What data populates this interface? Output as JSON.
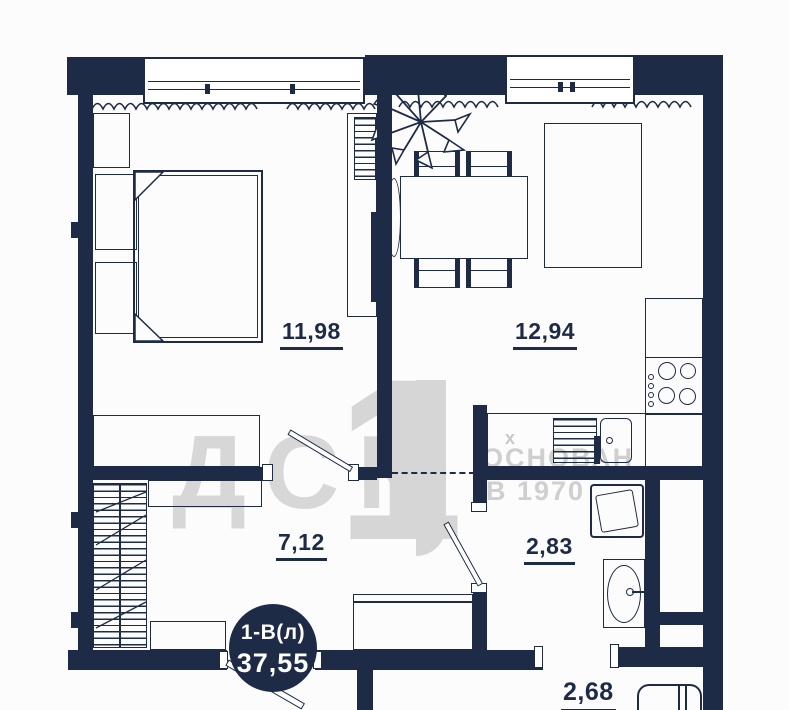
{
  "floor_plan": {
    "unit_badge": {
      "unit_type": "1-В(л)",
      "total_area": "37,55"
    },
    "rooms": [
      {
        "id": "bedroom",
        "area": "11,98"
      },
      {
        "id": "kitchen_living",
        "area": "12,94"
      },
      {
        "id": "hallway",
        "area": "7,12"
      },
      {
        "id": "bathroom",
        "area": "2,83"
      },
      {
        "id": "wc",
        "area": "2,68"
      }
    ],
    "watermark": {
      "company": "ДСК",
      "logo_numeral": "1",
      "founded_word": "ОСНОВАН",
      "founded_year_line": "В 1970",
      "vent_mark": "х"
    },
    "colors": {
      "wall": "#1e2b47",
      "background": "#fcfcfc",
      "watermark_gray": "#d7d7d7",
      "badge_fill": "#1e2b47",
      "badge_text": "#ffffff"
    }
  }
}
